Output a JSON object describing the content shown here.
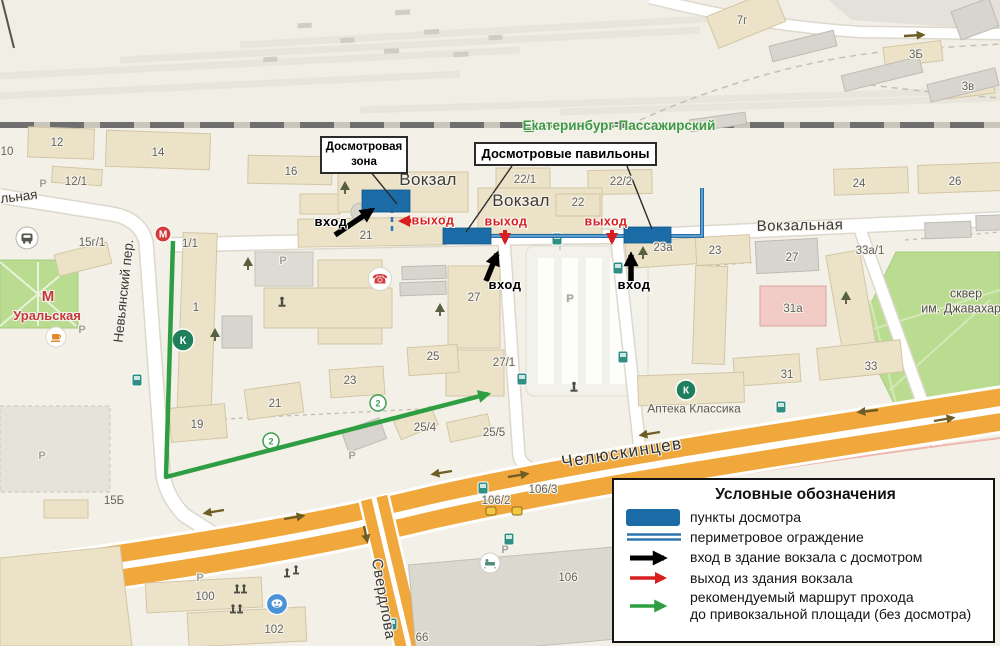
{
  "callouts": {
    "inspection_zone": "Досмотровая зона",
    "inspection_pavilions": "Досмотровые павильоны"
  },
  "legend": {
    "title": "Условные обозначения",
    "items": [
      {
        "symbol": "checkpoint-swatch",
        "label": "пункты досмотра"
      },
      {
        "symbol": "perimeter-fence-swatch",
        "label": "периметровое ограждение"
      },
      {
        "symbol": "black-arrow",
        "label": "вход в здание вокзала с досмотром"
      },
      {
        "symbol": "red-arrow",
        "label": "выход из здания вокзала"
      },
      {
        "symbol": "green-arrow",
        "label": "рекомендуемый маршрут прохода\nдо привокзальной площади (без досмотра)"
      }
    ]
  },
  "colors": {
    "checkpoint": "#1b6ba6",
    "perimeter_fence": "#2e75ad",
    "entry_arrow": "#000000",
    "exit_arrow": "#d81f1f",
    "route": "#2f9e43",
    "major_road": "#f0a73c",
    "park": "#b9dc90",
    "metro": "#c43a3a",
    "railway_label": "#3c9a47"
  },
  "map_labels": [
    {
      "text": "12",
      "x": 57,
      "y": 143,
      "cls": "bldg"
    },
    {
      "text": "10",
      "x": 7,
      "y": 152,
      "cls": "bldg"
    },
    {
      "text": "14",
      "x": 158,
      "y": 153,
      "cls": "bldg"
    },
    {
      "text": "12/1",
      "x": 76,
      "y": 182,
      "cls": "bldg"
    },
    {
      "text": "16",
      "x": 291,
      "y": 172,
      "cls": "bldg"
    },
    {
      "text": "21",
      "x": 366,
      "y": 236,
      "cls": "bldg"
    },
    {
      "text": "22/1",
      "x": 525,
      "y": 180,
      "cls": "bldg"
    },
    {
      "text": "22/2",
      "x": 621,
      "y": 182,
      "cls": "bldg"
    },
    {
      "text": "22",
      "x": 578,
      "y": 203,
      "cls": "bldg"
    },
    {
      "text": "24",
      "x": 859,
      "y": 184,
      "cls": "bldg"
    },
    {
      "text": "26",
      "x": 955,
      "y": 182,
      "cls": "bldg"
    },
    {
      "text": "7г",
      "x": 742,
      "y": 21,
      "cls": "bldg"
    },
    {
      "text": "3Б",
      "x": 916,
      "y": 55,
      "cls": "bldg"
    },
    {
      "text": "3в",
      "x": 968,
      "y": 87,
      "cls": "bldg"
    },
    {
      "text": "23а",
      "x": 663,
      "y": 248,
      "cls": "bldg"
    },
    {
      "text": "23",
      "x": 715,
      "y": 251,
      "cls": "bldg"
    },
    {
      "text": "27",
      "x": 792,
      "y": 258,
      "cls": "bldg"
    },
    {
      "text": "33а/1",
      "x": 870,
      "y": 251,
      "cls": "bldg"
    },
    {
      "text": "31а",
      "x": 793,
      "y": 309,
      "cls": "bldg"
    },
    {
      "text": "31",
      "x": 787,
      "y": 375,
      "cls": "bldg"
    },
    {
      "text": "33",
      "x": 871,
      "y": 367,
      "cls": "bldg"
    },
    {
      "text": "15г/1",
      "x": 92,
      "y": 243,
      "cls": "bldg"
    },
    {
      "text": "1/1",
      "x": 190,
      "y": 244,
      "cls": "bldg"
    },
    {
      "text": "1",
      "x": 196,
      "y": 308,
      "cls": "bldg"
    },
    {
      "text": "19",
      "x": 197,
      "y": 425,
      "cls": "bldg"
    },
    {
      "text": "21",
      "x": 275,
      "y": 404,
      "cls": "bldg"
    },
    {
      "text": "15Б",
      "x": 114,
      "y": 501,
      "cls": "bldg"
    },
    {
      "text": "25",
      "x": 433,
      "y": 357,
      "cls": "bldg"
    },
    {
      "text": "23",
      "x": 350,
      "y": 381,
      "cls": "bldg"
    },
    {
      "text": "25/4",
      "x": 425,
      "y": 428,
      "cls": "bldg"
    },
    {
      "text": "25/5",
      "x": 494,
      "y": 433,
      "cls": "bldg"
    },
    {
      "text": "27",
      "x": 474,
      "y": 298,
      "cls": "bldg"
    },
    {
      "text": "27/1",
      "x": 504,
      "y": 363,
      "cls": "bldg"
    },
    {
      "text": "106/2",
      "x": 496,
      "y": 501,
      "cls": "bldg"
    },
    {
      "text": "106/3",
      "x": 543,
      "y": 490,
      "cls": "bldg"
    },
    {
      "text": "106",
      "x": 568,
      "y": 578,
      "cls": "bldg"
    },
    {
      "text": "100",
      "x": 205,
      "y": 597,
      "cls": "bldg"
    },
    {
      "text": "102",
      "x": 274,
      "y": 630,
      "cls": "bldg"
    },
    {
      "text": "66",
      "x": 422,
      "y": 638,
      "cls": "bldg"
    },
    {
      "text": "Вокзал",
      "x": 428,
      "y": 180,
      "cls": "station",
      "name": "station-label"
    },
    {
      "text": "Вокзал",
      "x": 521,
      "y": 201,
      "cls": "station",
      "name": "station-label"
    },
    {
      "text": "Вокзальная",
      "x": 800,
      "y": 226,
      "cls": "street street-lg",
      "rot": -1,
      "name": "street-label"
    },
    {
      "text": "льная",
      "x": 19,
      "y": 197,
      "cls": "street",
      "rot": -7,
      "name": "street-label"
    },
    {
      "text": "Челюскинцев",
      "x": 622,
      "y": 453,
      "cls": "street street-xl",
      "rot": -9,
      "name": "street-label"
    },
    {
      "text": "Свердлова",
      "x": 383,
      "y": 599,
      "cls": "street street-lg",
      "rot": 80,
      "name": "street-label"
    },
    {
      "text": "Невьянский пер.",
      "x": 124,
      "y": 291,
      "cls": "street",
      "rot": -84,
      "name": "street-label"
    },
    {
      "text": "Екатеринбург-Пассажирский",
      "x": 619,
      "y": 126,
      "cls": "rail",
      "name": "railway-station-label"
    },
    {
      "text": "М",
      "x": 48,
      "y": 297,
      "cls": "metro metro-m",
      "name": "metro-station-label"
    },
    {
      "text": "Уральская",
      "x": 47,
      "y": 316,
      "cls": "metro",
      "name": "metro-station-label"
    },
    {
      "text": "Аптека Классика",
      "x": 694,
      "y": 409,
      "cls": "poi",
      "name": "pharmacy-label"
    },
    {
      "text": "сквер",
      "x": 966,
      "y": 294,
      "cls": "park-label"
    },
    {
      "text": "им. Джавахарла",
      "x": 968,
      "y": 309,
      "cls": "park-label"
    },
    {
      "text": "Р",
      "x": 43,
      "y": 185,
      "cls": "parking"
    },
    {
      "text": "Р",
      "x": 283,
      "y": 262,
      "cls": "parking"
    },
    {
      "text": "Р",
      "x": 42,
      "y": 457,
      "cls": "parking"
    },
    {
      "text": "Р",
      "x": 570,
      "y": 300,
      "cls": "parking"
    },
    {
      "text": "Р",
      "x": 352,
      "y": 457,
      "cls": "parking"
    },
    {
      "text": "Р",
      "x": 505,
      "y": 551,
      "cls": "parking"
    },
    {
      "text": "Р",
      "x": 200,
      "y": 579,
      "cls": "parking"
    },
    {
      "text": "Р",
      "x": 82,
      "y": 331,
      "cls": "parking"
    },
    {
      "text": "вход",
      "x": 331,
      "y": 222,
      "cls": "entrance",
      "name": "entrance-label"
    },
    {
      "text": "вход",
      "x": 505,
      "y": 285,
      "cls": "entrance",
      "name": "entrance-label"
    },
    {
      "text": "вход",
      "x": 634,
      "y": 285,
      "cls": "entrance",
      "name": "entrance-label"
    },
    {
      "text": "выход",
      "x": 433,
      "y": 221,
      "cls": "exit",
      "name": "exit-label"
    },
    {
      "text": "выход",
      "x": 506,
      "y": 222,
      "cls": "exit",
      "name": "exit-label"
    },
    {
      "text": "выход",
      "x": 606,
      "y": 222,
      "cls": "exit",
      "name": "exit-label"
    }
  ]
}
